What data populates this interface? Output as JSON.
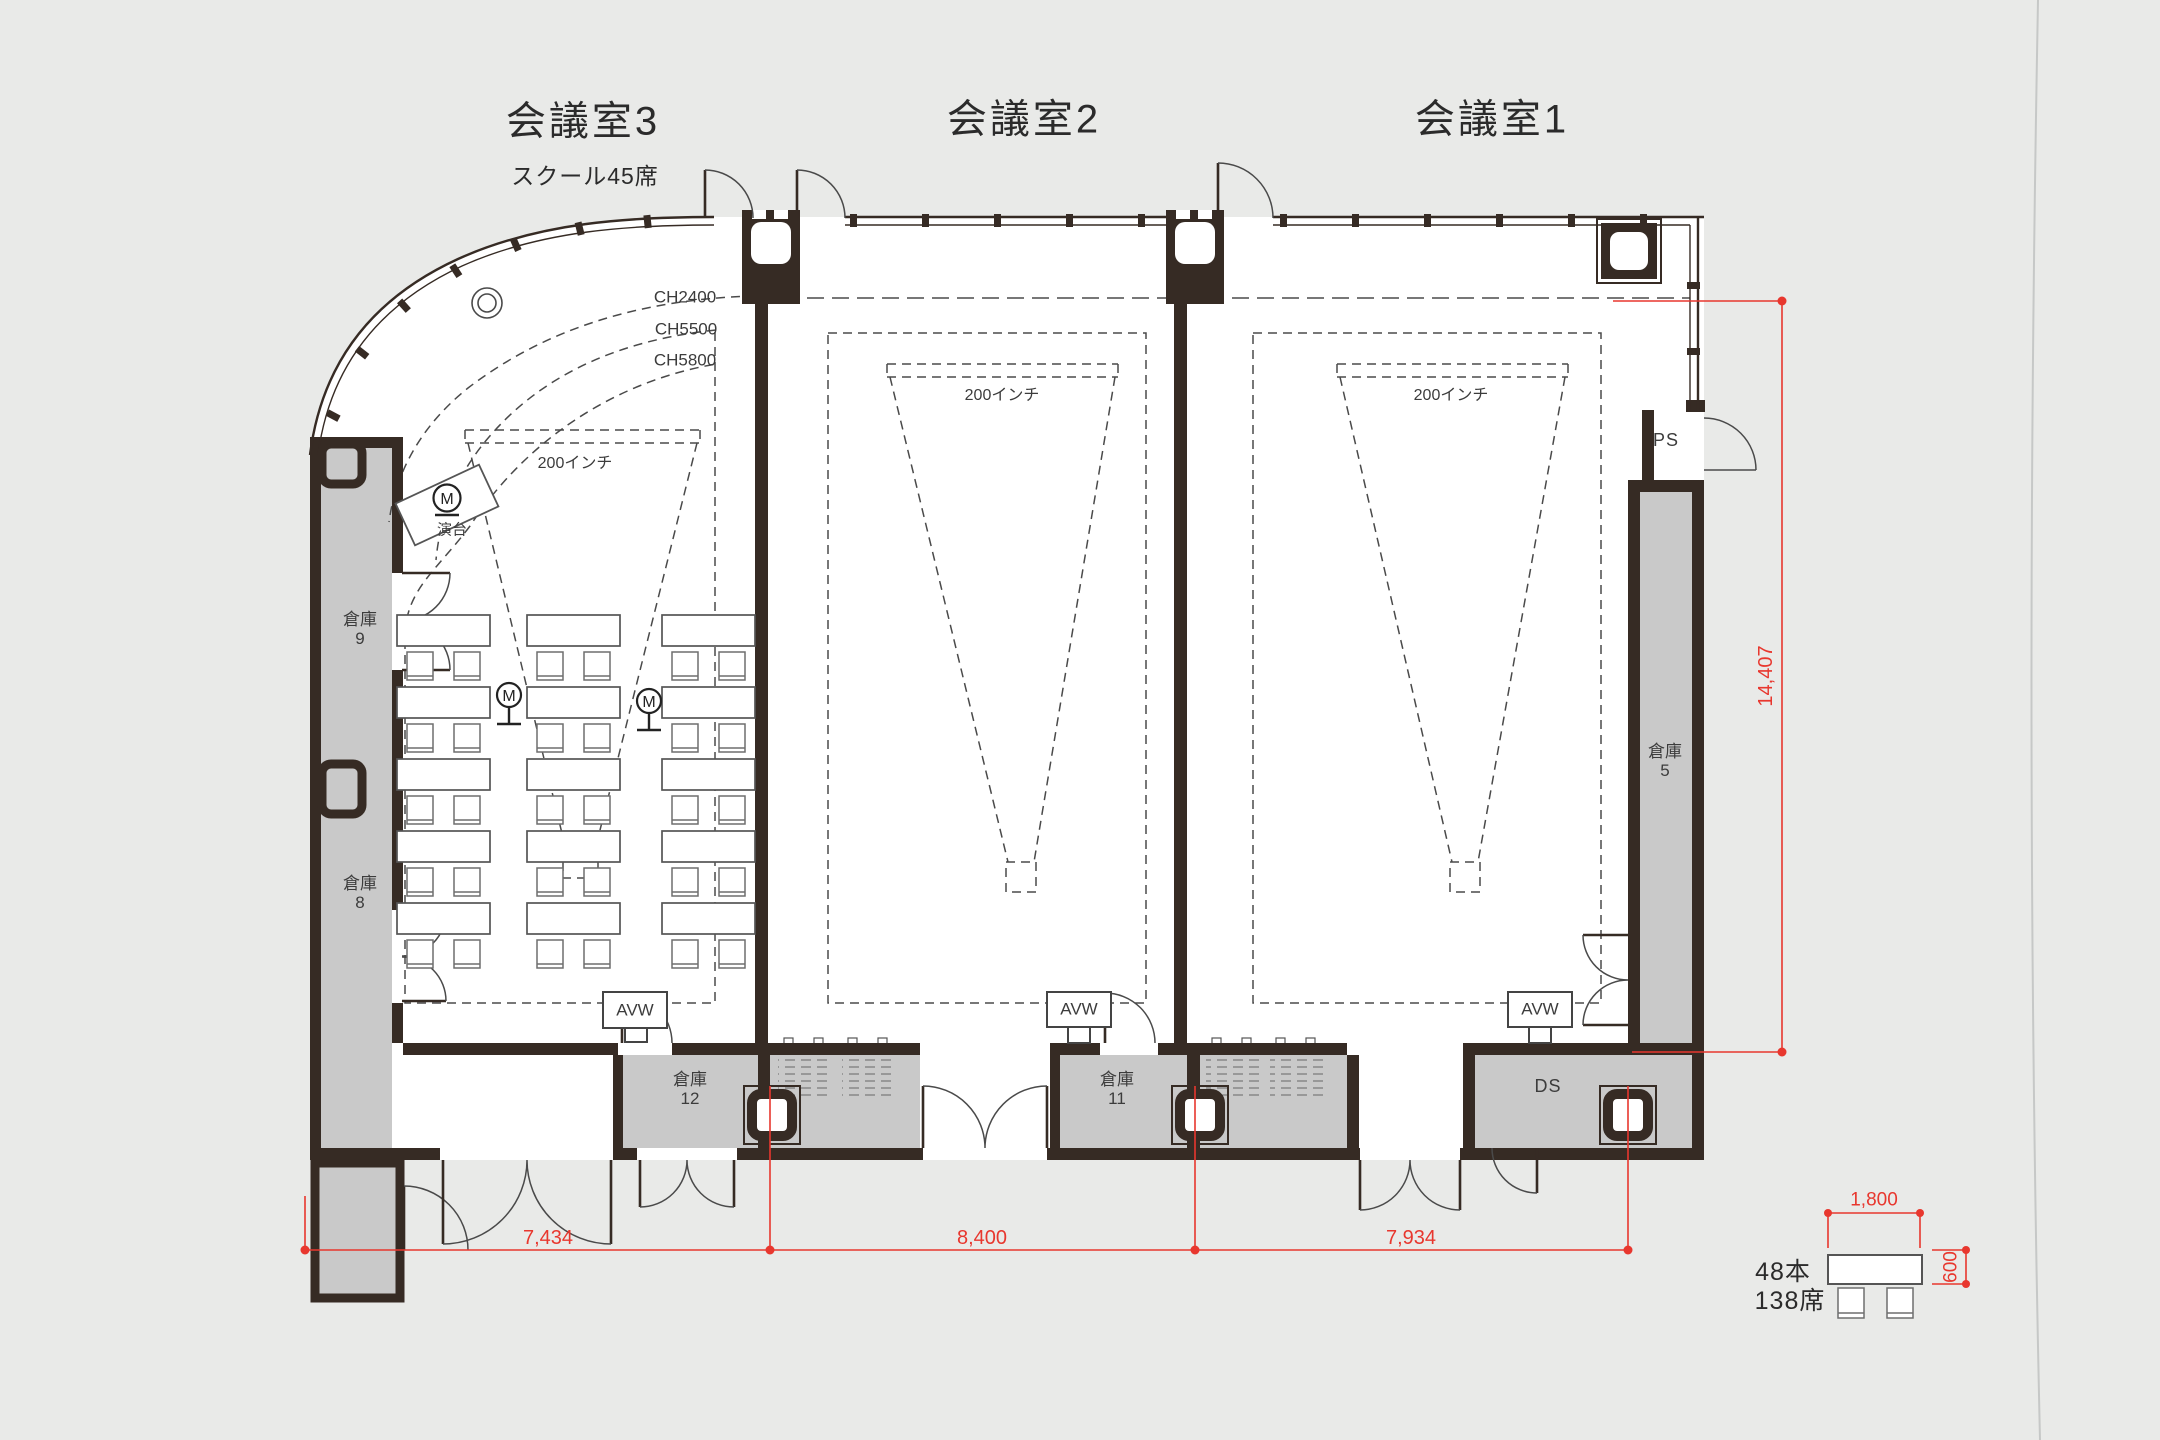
{
  "colors": {
    "background": "#e9eae8",
    "floor": "#ffffff",
    "wall": "#362b24",
    "storage_fill": "#c9c9c9",
    "dimension_red": "#e8372e"
  },
  "titles": {
    "room3": "会議室3",
    "room3_subtitle": "スクール45席",
    "room2": "会議室2",
    "room1": "会議室1"
  },
  "ceiling": {
    "ch2400": "CH2400",
    "ch5500": "CH5500",
    "ch5800": "CH5800"
  },
  "screen": {
    "size_label": "200インチ"
  },
  "storage": {
    "label": "倉庫",
    "no9": "9",
    "no8": "8",
    "no5": "5",
    "no12": "12",
    "no11": "11"
  },
  "service": {
    "ps": "PS",
    "ds": "DS"
  },
  "equipment": {
    "avw": "AVW",
    "lectern": "演台",
    "microphone": "M"
  },
  "dimensions": {
    "bottom_segments": [
      "7,434",
      "8,400",
      "7,934"
    ],
    "right_height": "14,407",
    "table_width": "1,800",
    "table_depth": "600"
  },
  "legend": {
    "table_count": "48本",
    "seat_count": "138席"
  }
}
